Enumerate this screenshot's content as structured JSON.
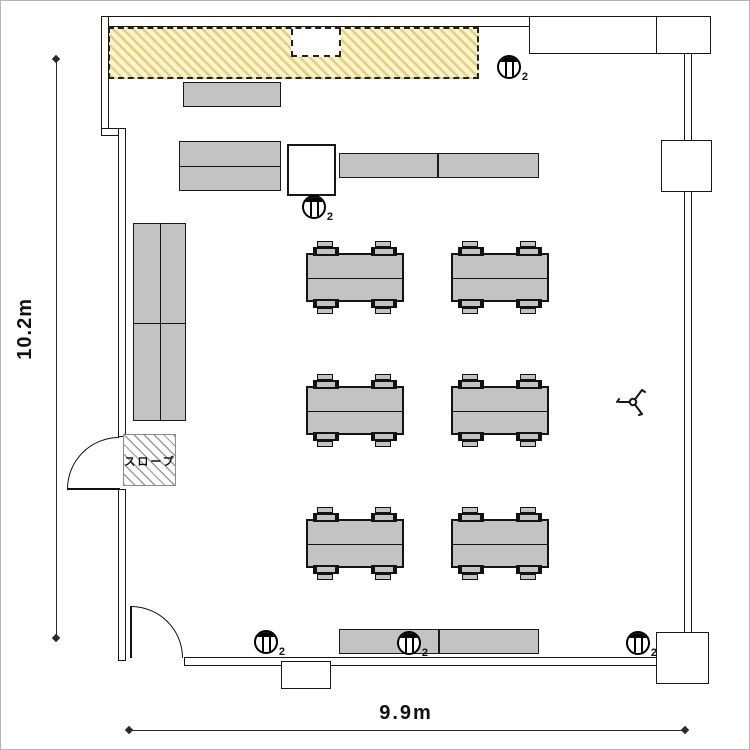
{
  "floor_plan": {
    "title": "classroom floor plan",
    "room": {
      "height_dimension_label": "10.2m",
      "width_dimension_label": "9.9m"
    },
    "ramp": {
      "label": "スロープ"
    },
    "colors": {
      "hatch_zone_fill": "#faf4d0",
      "hatch_zone_stripe": "#e6d077",
      "furniture_gray": "#c3c3c3",
      "wall_line": "#161616"
    },
    "outlets": {
      "icon": "power-outlet-icon",
      "count_label": "2",
      "positions": [
        {
          "x": 508,
          "y": 66
        },
        {
          "x": 313,
          "y": 206
        },
        {
          "x": 265,
          "y": 641
        },
        {
          "x": 408,
          "y": 642
        },
        {
          "x": 637,
          "y": 642
        }
      ]
    },
    "counters": [
      {
        "id": "shelf-top",
        "x": 182,
        "y": 81,
        "w": 98,
        "h": 25,
        "dividers": []
      },
      {
        "id": "shelf-row2-left",
        "x": 178,
        "y": 140,
        "w": 102,
        "h": 50,
        "dividers": [
          {
            "t": "h",
            "at": 0.5
          }
        ]
      },
      {
        "id": "counter-row2-a",
        "x": 338,
        "y": 152,
        "w": 99,
        "h": 25,
        "dividers": []
      },
      {
        "id": "counter-row2-b",
        "x": 437,
        "y": 152,
        "w": 101,
        "h": 25,
        "dividers": []
      },
      {
        "id": "cabinet-left",
        "x": 132,
        "y": 222,
        "w": 53,
        "h": 198,
        "dividers": [
          {
            "t": "h",
            "at": 0.505
          },
          {
            "t": "v",
            "at": 0.5
          }
        ]
      },
      {
        "id": "counter-bottom-a",
        "x": 338,
        "y": 628,
        "w": 100,
        "h": 25,
        "dividers": []
      },
      {
        "id": "counter-bottom-b",
        "x": 438,
        "y": 628,
        "w": 100,
        "h": 25,
        "dividers": []
      }
    ],
    "worktables": {
      "columns_x": [
        305,
        450
      ],
      "rows_y": [
        252,
        385,
        518
      ],
      "width": 98,
      "height": 49,
      "chair_offsets_x": [
        5,
        63
      ],
      "chairs_per_table": 4
    }
  }
}
